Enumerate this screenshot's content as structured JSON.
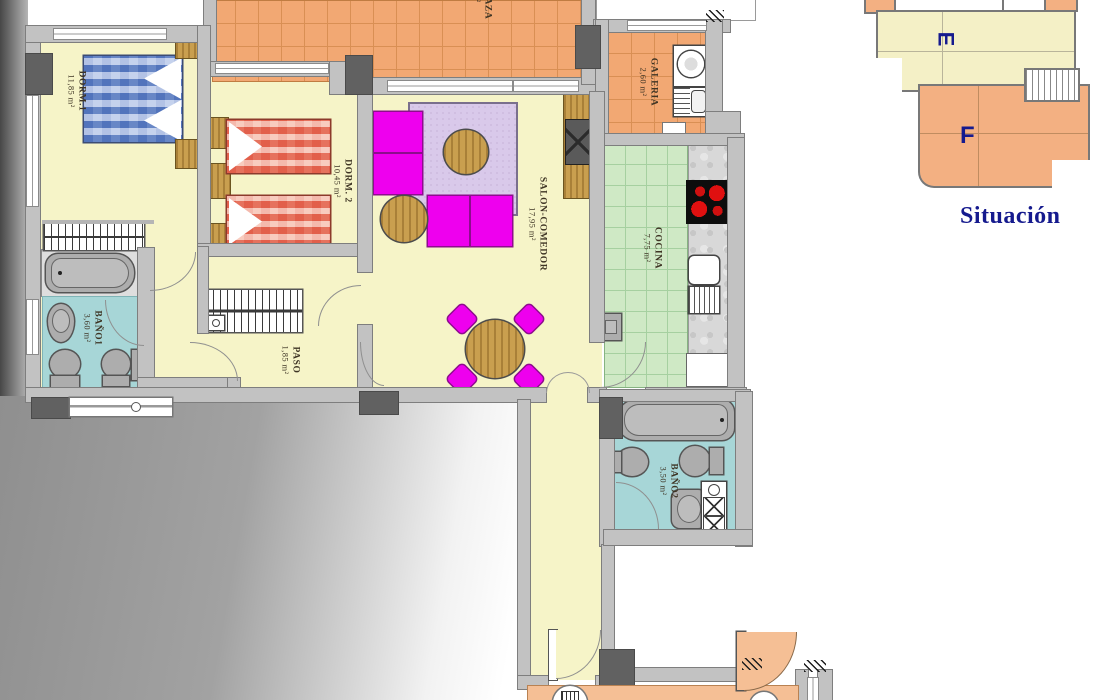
{
  "plan_title": "Apartment floor plan",
  "rooms": {
    "dorm1": {
      "label": "DORM.1",
      "area": "11,85 m²"
    },
    "dorm2": {
      "label": "DORM. 2",
      "area": "10,45 m²"
    },
    "salon": {
      "label": "SALON-COMEDOR",
      "area": "17,95 m²"
    },
    "cocina": {
      "label": "COCINA",
      "area": "7,75 m²"
    },
    "galeria": {
      "label": "GALERIA",
      "area": "2,60 m²"
    },
    "bano1": {
      "label": "BAÑO1",
      "area": "3,60 m²"
    },
    "bano2": {
      "label": "BAÑO2",
      "area": "3,50 m²"
    },
    "paso": {
      "label": "PASO",
      "area": "1,85 m²"
    },
    "terraza": {
      "label": "TERRAZA",
      "area": "5 m²"
    }
  },
  "situacion": {
    "title": "Situación",
    "unit_e": "E",
    "unit_f": "F"
  },
  "colors": {
    "floor_cream": "#f6f4c8",
    "terrace_tile": "#f2a873",
    "kitchen_tile": "#cfe9c5",
    "bathroom": "#a7d6d7",
    "wall": "#c2c2c2",
    "wall_dark": "#616161",
    "sofa_magenta": "#ee00ee",
    "rug_lilac": "#d9c9ea",
    "wood": "#c99f4f",
    "hall_orange": "#f5bf95",
    "unit_e_fill": "#f4f0c6",
    "unit_f_fill": "#f3b082",
    "label_navy": "#151a8e"
  }
}
